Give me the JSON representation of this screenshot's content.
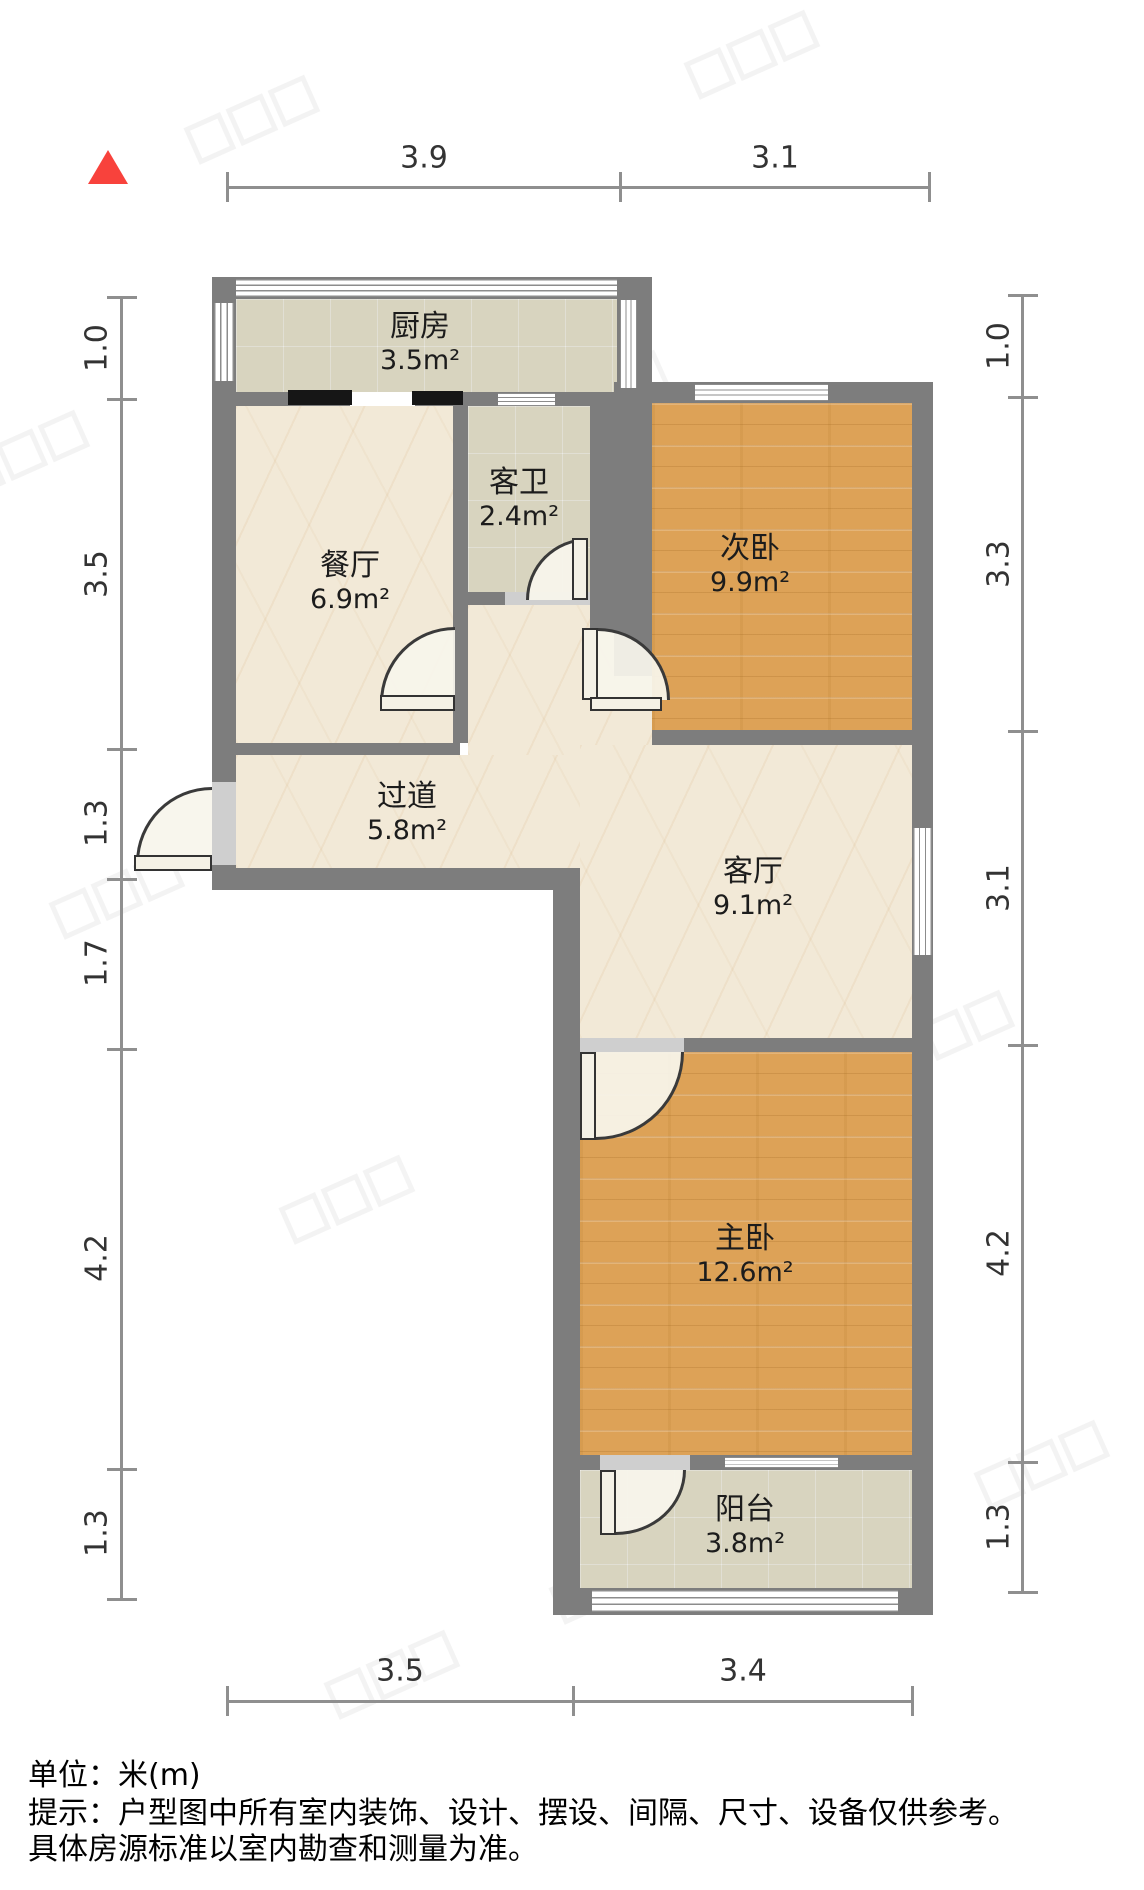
{
  "north_indicator": {
    "shape": "triangle-up",
    "color": "#f8423c"
  },
  "rooms": [
    {
      "id": "kitchen",
      "name": "厨房",
      "area": "3.5m²"
    },
    {
      "id": "dining",
      "name": "餐厅",
      "area": "6.9m²"
    },
    {
      "id": "bathroom",
      "name": "客卫",
      "area": "2.4m²"
    },
    {
      "id": "bedroom2",
      "name": "次卧",
      "area": "9.9m²"
    },
    {
      "id": "hallway",
      "name": "过道",
      "area": "5.8m²"
    },
    {
      "id": "living",
      "name": "客厅",
      "area": "9.1m²"
    },
    {
      "id": "master",
      "name": "主卧",
      "area": "12.6m²"
    },
    {
      "id": "balcony",
      "name": "阳台",
      "area": "3.8m²"
    }
  ],
  "dimensions": {
    "top": [
      "3.9",
      "3.1"
    ],
    "bottom": [
      "3.5",
      "3.4"
    ],
    "left": [
      "1.0",
      "3.5",
      "1.3",
      "1.7",
      "4.2",
      "1.3"
    ],
    "right": [
      "1.0",
      "3.3",
      "3.1",
      "4.2",
      "1.3"
    ]
  },
  "footer": {
    "unit": "单位：米(m)",
    "tip_line1": "提示：户型图中所有室内装饰、设计、摆设、间隔、尺寸、设备仅供参考。",
    "tip_line2": "具体房源标准以室内勘查和测量为准。"
  },
  "colors": {
    "wall": "#7d7d7d",
    "wood_floor": "#dda257",
    "tile_floor": "#d8d4bf",
    "marble_floor": "#f2e9d7",
    "north_arrow": "#f8423c",
    "dimension_line": "#8f8f8f"
  }
}
